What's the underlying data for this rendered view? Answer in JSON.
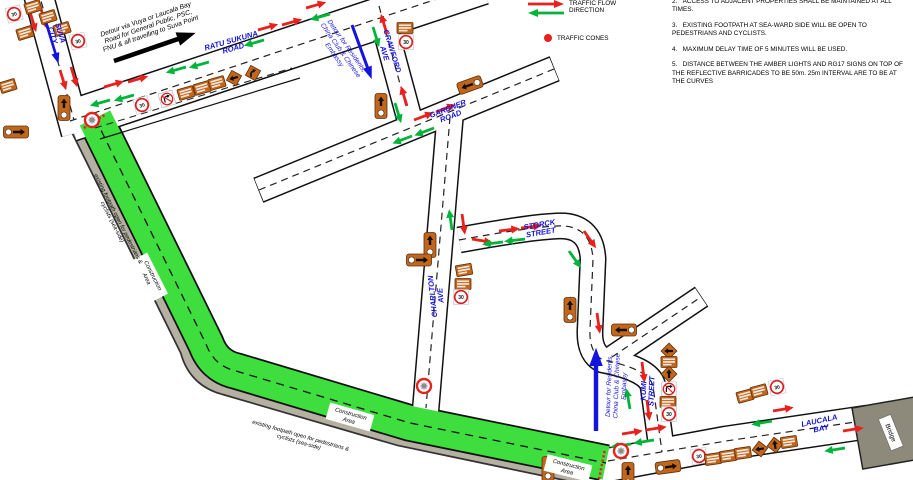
{
  "legend": {
    "flow_label": "TRAFFIC FLOW\nDIRECTION",
    "cones_label": "TRAFFIC CONES"
  },
  "notes": [
    {
      "num": "2.",
      "text": "ACCESS TO ADJACENT PROPERTIES SHALL BE MAINTAINED AT ALL TIMES."
    },
    {
      "num": "3.",
      "text": "EXISTING FOOTPATH AT SEA-WARD SIDE WILL BE OPEN TO PEDESTRIANS AND CYCLISTS."
    },
    {
      "num": "4.",
      "text": "MAXIMUM DELAY TIME OF 5 MINUTES WILL BE USED."
    },
    {
      "num": "5.",
      "text": "DISTANCE BETWEEN THE AMBER LIGHTS AND RG17 SIGNS ON TOP OF THE REFLECTIVE BARRICADES TO BE 50m. 25m INTERVAL ARE TO BE AT THE CURVES"
    }
  ],
  "colors": {
    "flow_east": "#e8211d",
    "flow_west": "#00b43a",
    "detour_blue": "#1414e0",
    "construction_green": "#3ede3e",
    "footpath_gray": "#b5b0a1",
    "sign_orange": "#c2661c",
    "bridge_gray": "#8d8a7b",
    "cone_red": "#e8211d"
  },
  "map": {
    "speed_limit_text": "30",
    "streets": [
      {
        "id": "suva-city",
        "lines": [
          "SUVA",
          "CITY"
        ],
        "x": 57,
        "y": 34,
        "rot": 73
      },
      {
        "id": "ratu-sukuna-road",
        "lines": [
          "RATU SUKUNA",
          "ROAD"
        ],
        "x": 232,
        "y": 44,
        "rot": -16
      },
      {
        "id": "crawford-ave",
        "lines": [
          "CRAWFORD",
          "AVE"
        ],
        "x": 389,
        "y": 52,
        "rot": 73
      },
      {
        "id": "gardner-road",
        "lines": [
          "GARDNER",
          "ROAD"
        ],
        "x": 449,
        "y": 112,
        "rot": -21
      },
      {
        "id": "charlton-ave",
        "lines": [
          "CHARLTON",
          "AVE"
        ],
        "x": 436,
        "y": 296,
        "rot": -96
      },
      {
        "id": "storck-street",
        "lines": [
          "STORCK",
          "STREET"
        ],
        "x": 540,
        "y": 228,
        "rot": -10
      },
      {
        "id": "kumi-street",
        "lines": [
          "KUMI",
          "STREET"
        ],
        "x": 647,
        "y": 391,
        "rot": -88
      },
      {
        "id": "laucala-bay",
        "lines": [
          "LAUCALA",
          "BAY"
        ],
        "x": 820,
        "y": 424,
        "rot": -12
      }
    ],
    "annotations": [
      {
        "id": "detour-public",
        "cls": "ann-black",
        "lines": [
          "Detour via Vuya or Laucala Bay",
          "Road for General Public, PSC,",
          "FNU & all travelling to Suva Point"
        ],
        "x": 148,
        "y": 26,
        "rot": -19
      },
      {
        "id": "detour-residents-crawford",
        "cls": "ann-blue",
        "lines": [
          "Detour for Residents,",
          "China Club & Chinese",
          "Embassy"
        ],
        "x": 341,
        "y": 50,
        "rot": 55
      },
      {
        "id": "detour-residents-kumi",
        "cls": "ann-blue",
        "lines": [
          "Detour for Residents,",
          "China Club & Chinese",
          "Embassy"
        ],
        "x": 616,
        "y": 386,
        "rot": -88
      },
      {
        "id": "footpath-note-1",
        "cls": "ann-small",
        "lines": [
          "existing footpath open for pedestrians &",
          "cyclists (sea-side)"
        ],
        "x": 116,
        "y": 220,
        "rot": 63
      },
      {
        "id": "footpath-note-2",
        "cls": "ann-small",
        "lines": [
          "existing footpath open for pedestrians &",
          "cyclists (sea-side)"
        ],
        "x": 300,
        "y": 438,
        "rot": 16
      }
    ],
    "construction": {
      "label_lines": [
        "Construction",
        "Area"
      ],
      "boxes": [
        {
          "x": 150,
          "y": 277,
          "rot": 63
        },
        {
          "x": 350,
          "y": 417,
          "rot": 16
        },
        {
          "x": 568,
          "y": 468,
          "rot": 14
        }
      ]
    },
    "bridge": {
      "label": "Bridge"
    },
    "signs": [
      [
        "c30",
        14,
        14,
        -15
      ],
      [
        "rect",
        33,
        7,
        -17
      ],
      [
        "rect",
        25,
        33,
        -17
      ],
      [
        "rect",
        48,
        17,
        -17
      ],
      [
        "rect",
        62,
        29,
        -17
      ],
      [
        "c30",
        78,
        41,
        -12
      ],
      [
        "rect",
        8,
        86,
        -17
      ],
      [
        "va",
        64,
        108,
        0
      ],
      [
        "hr",
        16,
        132,
        0
      ],
      [
        "c30",
        142,
        105,
        -16
      ],
      [
        "nt",
        167,
        99,
        -16
      ],
      [
        "rect",
        186,
        93,
        -16
      ],
      [
        "rect",
        202,
        88,
        -16
      ],
      [
        "rect",
        217,
        83,
        -16
      ],
      [
        "dl",
        234,
        78,
        -16
      ],
      [
        "dc",
        253,
        73,
        -16
      ],
      [
        "rect",
        405,
        28,
        0
      ],
      [
        "c30",
        406,
        42,
        0
      ],
      [
        "va",
        381,
        106,
        0
      ],
      [
        "hl",
        470,
        85,
        -20
      ],
      [
        "va",
        430,
        245,
        0
      ],
      [
        "hr",
        419,
        260,
        0
      ],
      [
        "rect",
        464,
        270,
        -10
      ],
      [
        "rect",
        463,
        284,
        0
      ],
      [
        "c30",
        461,
        297,
        0
      ],
      [
        "va",
        570,
        310,
        0
      ],
      [
        "hl",
        624,
        330,
        0
      ],
      [
        "dl",
        669,
        351,
        0
      ],
      [
        "rect",
        669,
        362,
        0
      ],
      [
        "du",
        669,
        374,
        0
      ],
      [
        "nt",
        669,
        389,
        0
      ],
      [
        "rect",
        668,
        402,
        0
      ],
      [
        "c30",
        669,
        414,
        0
      ],
      [
        "rect",
        745,
        396,
        -15
      ],
      [
        "rect",
        759,
        391,
        -15
      ],
      [
        "c30",
        777,
        387,
        -12
      ],
      [
        "c30",
        699,
        456,
        -8
      ],
      [
        "rect",
        713,
        459,
        -8
      ],
      [
        "rect",
        728,
        456,
        -8
      ],
      [
        "rect",
        743,
        453,
        -8
      ],
      [
        "dl",
        760,
        449,
        -8
      ],
      [
        "du",
        775,
        445,
        -8
      ],
      [
        "rect",
        789,
        442,
        -8
      ],
      [
        "va",
        548,
        469,
        0
      ],
      [
        "hr",
        668,
        467,
        -8
      ],
      [
        "va",
        628,
        475,
        0
      ],
      [
        "x",
        92,
        120,
        0
      ],
      [
        "x",
        424,
        386,
        0
      ],
      [
        "x",
        621,
        451,
        0
      ]
    ],
    "arrows": {
      "red": [
        [
          30,
          12,
          73
        ],
        [
          41,
          9,
          73
        ],
        [
          60,
          70,
          73
        ],
        [
          71,
          67,
          73
        ],
        [
          104,
          87,
          -16
        ],
        [
          128,
          82,
          -16
        ],
        [
          258,
          30,
          -16
        ],
        [
          282,
          25,
          -16
        ],
        [
          306,
          8,
          -16
        ],
        [
          387,
          34,
          253
        ],
        [
          407,
          106,
          253
        ],
        [
          414,
          120,
          -21
        ],
        [
          436,
          112,
          -21
        ],
        [
          462,
          214,
          82
        ],
        [
          472,
          239,
          10
        ],
        [
          499,
          231,
          -7
        ],
        [
          521,
          228,
          -7
        ],
        [
          584,
          231,
          55
        ],
        [
          597,
          313,
          82
        ],
        [
          642,
          362,
          83
        ],
        [
          647,
          400,
          83
        ],
        [
          622,
          434,
          -9
        ],
        [
          646,
          430,
          -9
        ],
        [
          773,
          411,
          -10
        ],
        [
          843,
          431,
          -9
        ]
      ],
      "green": [
        [
          110,
          100,
          164
        ],
        [
          134,
          95,
          164
        ],
        [
          186,
          67,
          164
        ],
        [
          209,
          62,
          164
        ],
        [
          264,
          40,
          164
        ],
        [
          330,
          14,
          164
        ],
        [
          373,
          27,
          73
        ],
        [
          395,
          103,
          73
        ],
        [
          412,
          136,
          159
        ],
        [
          434,
          128,
          159
        ],
        [
          452,
          230,
          262
        ],
        [
          503,
          242,
          173
        ],
        [
          525,
          239,
          173
        ],
        [
          569,
          251,
          55
        ],
        [
          573,
          317,
          262
        ],
        [
          630,
          409,
          260
        ],
        [
          631,
          444,
          171
        ],
        [
          654,
          440,
          171
        ],
        [
          772,
          421,
          170
        ],
        [
          845,
          448,
          171
        ]
      ],
      "long": [
        [
          "b",
          44,
          16,
          73,
          0.78
        ],
        [
          "k",
          114,
          61,
          -19,
          1.35
        ],
        [
          "b",
          352,
          25,
          70,
          0.9
        ],
        [
          "b",
          596,
          431,
          -90,
          1.3
        ]
      ]
    },
    "cone_lines": [
      [
        84,
        128,
        106,
        114
      ],
      [
        599,
        479,
        605,
        449
      ]
    ]
  }
}
